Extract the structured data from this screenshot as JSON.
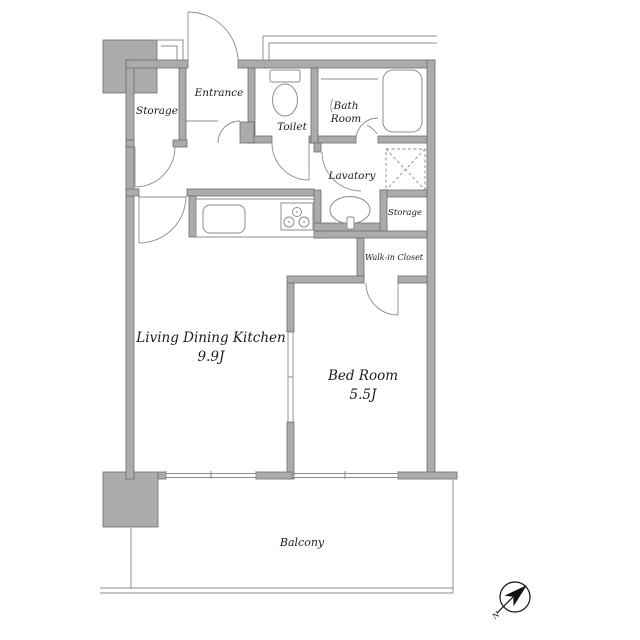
{
  "rooms": {
    "entrance": {
      "label": "Entrance"
    },
    "storage_entrance": {
      "label": "Storage"
    },
    "toilet": {
      "label": "Toilet"
    },
    "bath": {
      "line1": "Bath",
      "line2": "Room"
    },
    "lavatory": {
      "label": "Lavatory"
    },
    "storage_utility": {
      "label": "Storage"
    },
    "walk_in_closet": {
      "label": "Walk-in Closet"
    },
    "ldk": {
      "label": "Living Dining Kitchen",
      "area": "9.9J"
    },
    "bedroom": {
      "label": "Bed Room",
      "area": "5.5J"
    },
    "balcony": {
      "label": "Balcony"
    }
  },
  "compass": {
    "north_label": "N"
  },
  "colors": {
    "wall_fill": "#ababab",
    "wall_stroke": "#6e6e6e",
    "line": "#8c8c8c",
    "text": "#1c1c1c"
  }
}
